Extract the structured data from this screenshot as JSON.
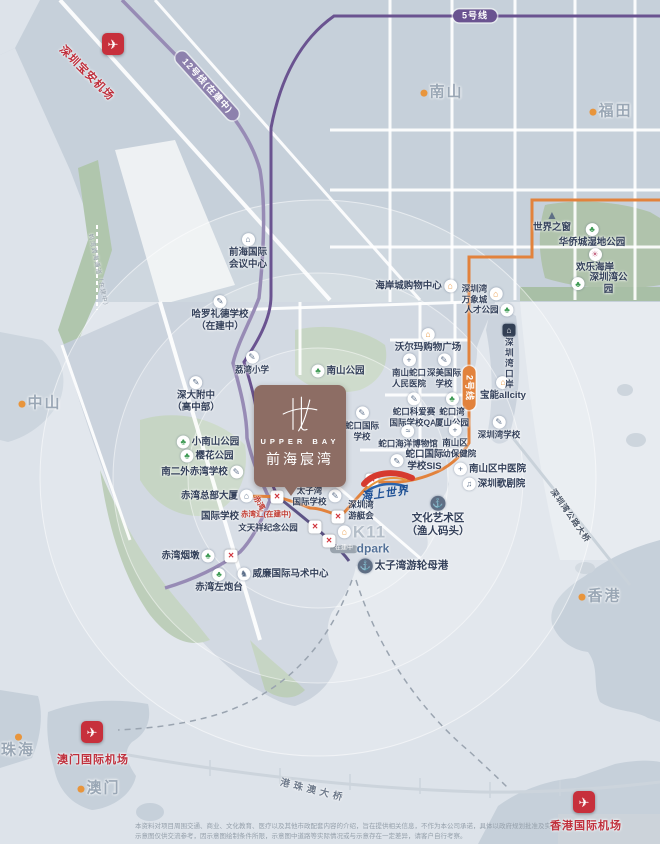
{
  "logo": {
    "name_en": "UPPER BAY",
    "name_cn": "前海宸湾"
  },
  "sea_world": {
    "label": "海上世界"
  },
  "station_glyph": "×",
  "icon_glyphs": {
    "park": "♣",
    "school": "✎",
    "shop": "⌂",
    "hospital": "+",
    "building": "⌂",
    "anchor": "⚓",
    "museum": "≈",
    "theater": "♫",
    "horse": "♞",
    "customs": "⌂",
    "pyramid": "▲",
    "attraction": "☀",
    "citydot": "",
    "airport": "✈"
  },
  "colors": {
    "brand_brown": "#8d6d64",
    "metro_purple": "#6a5390",
    "metro_purple_light": "#978bb5",
    "metro_orange": "#e2823c",
    "airport_red": "#c7303c",
    "label_dark": "#33405a",
    "sea": "#dde3ea",
    "land": "#c2ccd7",
    "park_green": "#b2c6ae"
  },
  "stations": [
    [
      277,
      497
    ],
    [
      372,
      480
    ],
    [
      338,
      517
    ],
    [
      315,
      527
    ],
    [
      329,
      541
    ],
    [
      231,
      556
    ]
  ],
  "pois": [
    {
      "id": "line5-pill",
      "label": "5号线",
      "x": 475,
      "y": 16,
      "cls": "pillp"
    },
    {
      "id": "line12-pill",
      "label": "12号线(在建中)",
      "x": 207,
      "y": 86,
      "cls": "pillp pill-l12",
      "rot": 48
    },
    {
      "id": "line2-pill",
      "label": "2号线",
      "x": 469,
      "y": 388,
      "cls": "pillp pill-l2",
      "rot": 90
    },
    {
      "id": "shenzhen-airport-icon",
      "x": 113,
      "y": 44,
      "icon": "airport"
    },
    {
      "id": "shenzhen-airport-label",
      "label": "深圳宝安机场",
      "x": 86,
      "y": 74,
      "cls": "airport-name",
      "rot": 45
    },
    {
      "id": "qianhai-conference-center",
      "label": "前海国际\n会议中心",
      "x": 248,
      "y": 252,
      "icon": "building",
      "ipos": "top"
    },
    {
      "id": "harrow-lide-school",
      "label": "哈罗礼德学校\n（在建中）",
      "x": 220,
      "y": 314,
      "icon": "school",
      "ipos": "top"
    },
    {
      "id": "liwan-primary-school",
      "label": "荔湾小学",
      "x": 252,
      "y": 363,
      "icon": "school",
      "ipos": "top",
      "cls": "small"
    },
    {
      "id": "nanshan-park",
      "label": "南山公园",
      "x": 338,
      "y": 371,
      "icon": "park",
      "ipos": "left"
    },
    {
      "id": "shenda-high-school",
      "label": "深大附中\n（高中部）",
      "x": 196,
      "y": 395,
      "icon": "school",
      "ipos": "top"
    },
    {
      "id": "xiaonanshan-park",
      "label": "小南山公园",
      "x": 208,
      "y": 442,
      "icon": "park",
      "ipos": "left"
    },
    {
      "id": "yinghua-park",
      "label": "樱花公园",
      "x": 207,
      "y": 456,
      "icon": "park",
      "ipos": "left"
    },
    {
      "id": "nanerwai-chiwan-school",
      "label": "南二外赤湾学校",
      "x": 202,
      "y": 472,
      "icon": "school",
      "ipos": "right"
    },
    {
      "id": "chiwan-headquarters-tower",
      "label": "赤湾总部大厦",
      "x": 217,
      "y": 496,
      "icon": "building",
      "ipos": "right"
    },
    {
      "id": "international-school",
      "label": "国际学校",
      "x": 220,
      "y": 517
    },
    {
      "id": "chiwanhui-label",
      "label": "赤湾汇(在建中)",
      "x": 266,
      "y": 514,
      "cls": "red tiny",
      "rot": 0
    },
    {
      "id": "chiwan-station-label",
      "label": "赤湾",
      "x": 259,
      "y": 503,
      "cls": "red tiny",
      "rot": 60
    },
    {
      "id": "wentianxiang-memorial-park",
      "label": "文天祥纪念公园",
      "x": 268,
      "y": 528,
      "cls": "small"
    },
    {
      "id": "chiwan-yandun",
      "label": "赤湾烟墩",
      "x": 188,
      "y": 556,
      "icon": "park",
      "ipos": "right"
    },
    {
      "id": "chiwan-left-fort",
      "label": "赤湾左炮台",
      "x": 219,
      "y": 581,
      "icon": "park",
      "ipos": "top"
    },
    {
      "id": "william-equestrian-center",
      "label": "威廉国际马术中心",
      "x": 283,
      "y": 574,
      "icon": "horse",
      "ipos": "left"
    },
    {
      "id": "taiziwan-international-school",
      "label": "太子湾\n国际学校",
      "x": 317,
      "y": 496,
      "icon": "school",
      "ipos": "right",
      "cls": "small"
    },
    {
      "id": "shenzhen-bay-yacht-club",
      "label": "深圳湾\n游艇会",
      "x": 361,
      "y": 510,
      "cls": "small"
    },
    {
      "id": "k11",
      "label": "K11",
      "x": 362,
      "y": 532,
      "icon": "shop",
      "ipos": "left",
      "cls": "k11"
    },
    {
      "id": "dpark-pill",
      "label": "在建中",
      "x": 344,
      "y": 549,
      "cls": "pill-grey"
    },
    {
      "id": "dpark",
      "label": "dpark",
      "x": 373,
      "y": 549,
      "cls": "dpark"
    },
    {
      "id": "taiziwan-cruise-home-port",
      "label": "太子湾游轮母港",
      "x": 403,
      "y": 566,
      "icon": "anchor",
      "ipos": "left",
      "cls": "bold11"
    },
    {
      "id": "culture-art-area",
      "label": "文化艺术区\n（渔人码头）",
      "x": 438,
      "y": 517,
      "icon": "anchor",
      "ipos": "top",
      "cls": "bold11"
    },
    {
      "id": "shekou-international-school",
      "label": "蛇口国际\n学校",
      "x": 362,
      "y": 424,
      "icon": "school",
      "ipos": "top",
      "cls": "small"
    },
    {
      "id": "qai-international-school",
      "label": "蛇口科爱赛\n国际学校QAI",
      "x": 414,
      "y": 410,
      "icon": "school",
      "ipos": "top",
      "cls": "small"
    },
    {
      "id": "wanxiashan-park",
      "label": "蛇口湾\n厦山公园",
      "x": 452,
      "y": 410,
      "icon": "park",
      "ipos": "top",
      "cls": "small"
    },
    {
      "id": "shekou-marine-museum",
      "label": "蛇口海洋博物馆",
      "x": 408,
      "y": 437,
      "icon": "museum",
      "ipos": "top",
      "cls": "small"
    },
    {
      "id": "fuyou-hospital",
      "label": "南山区\n妇幼保健院",
      "x": 455,
      "y": 441,
      "icon": "hospital",
      "ipos": "top",
      "cls": "small"
    },
    {
      "id": "sis-school",
      "label": "蛇口国际\n学校SIS",
      "x": 417,
      "y": 461,
      "icon": "school",
      "ipos": "left"
    },
    {
      "id": "nanshan-tcm-hospital",
      "label": "南山区中医院",
      "x": 490,
      "y": 469,
      "icon": "hospital",
      "ipos": "left"
    },
    {
      "id": "shenzhen-opera-house",
      "label": "深圳歌剧院",
      "x": 494,
      "y": 484,
      "icon": "theater",
      "ipos": "left"
    },
    {
      "id": "shenzhen-bay-school",
      "label": "深圳湾学校",
      "x": 499,
      "y": 428,
      "icon": "school",
      "ipos": "top",
      "cls": "small"
    },
    {
      "id": "baoneng-allcity",
      "label": "宝能allcity",
      "x": 503,
      "y": 389,
      "icon": "shop",
      "ipos": "top"
    },
    {
      "id": "shenzhen-bay-checkpoint",
      "label": "深圳湾口岸",
      "x": 509,
      "y": 357,
      "icon": "customs",
      "ipos": "top",
      "cls": "vert small"
    },
    {
      "id": "walmart-plaza",
      "label": "沃尔玛购物广场",
      "x": 428,
      "y": 341,
      "icon": "shop",
      "ipos": "top"
    },
    {
      "id": "shekou-people-hospital",
      "label": "南山蛇口\n人民医院",
      "x": 409,
      "y": 371,
      "icon": "hospital",
      "ipos": "top",
      "cls": "small"
    },
    {
      "id": "shenmei-international-school",
      "label": "深美国际\n学校",
      "x": 444,
      "y": 371,
      "icon": "school",
      "ipos": "top",
      "cls": "small"
    },
    {
      "id": "rencai-park",
      "label": "人才公园",
      "x": 489,
      "y": 310,
      "icon": "park",
      "ipos": "right",
      "cls": "small"
    },
    {
      "id": "shenzhen-bay-mixc",
      "label": "深圳湾\n万象城",
      "x": 482,
      "y": 294,
      "icon": "shop",
      "ipos": "right",
      "cls": "small"
    },
    {
      "id": "coastal-city-mall",
      "label": "海岸城购物中心",
      "x": 416,
      "y": 286,
      "icon": "shop",
      "ipos": "right"
    },
    {
      "id": "window-of-the-world",
      "label": "世界之窗",
      "x": 552,
      "y": 221,
      "icon": "pyramid",
      "ipos": "top"
    },
    {
      "id": "oct-wetland-park",
      "label": "华侨城湿地公园",
      "x": 592,
      "y": 236,
      "icon": "park",
      "ipos": "top"
    },
    {
      "id": "happy-coast",
      "label": "欢乐海岸",
      "x": 595,
      "y": 261,
      "icon": "attraction",
      "ipos": "top"
    },
    {
      "id": "shenzhen-bay-park",
      "label": "深圳湾公园",
      "x": 601,
      "y": 284,
      "icon": "park",
      "ipos": "left"
    },
    {
      "id": "city-nanshan",
      "label": "南山",
      "x": 442,
      "y": 93,
      "icon": "citydot",
      "ipos": "left",
      "cls": "city"
    },
    {
      "id": "city-futian",
      "label": "福田",
      "x": 611,
      "y": 112,
      "icon": "citydot",
      "ipos": "left",
      "cls": "city"
    },
    {
      "id": "city-zhongshan",
      "label": "中山",
      "x": 40,
      "y": 404,
      "icon": "citydot",
      "ipos": "left",
      "cls": "city"
    },
    {
      "id": "city-zhuhai",
      "label": "珠海",
      "x": 18,
      "y": 747,
      "icon": "citydot",
      "ipos": "top",
      "cls": "city"
    },
    {
      "id": "city-macau",
      "label": "澳门",
      "x": 99,
      "y": 789,
      "icon": "citydot",
      "ipos": "left",
      "cls": "city"
    },
    {
      "id": "city-hongkong",
      "label": "香港",
      "x": 600,
      "y": 597,
      "icon": "citydot",
      "ipos": "left",
      "cls": "city"
    },
    {
      "id": "macau-airport-icon",
      "x": 92,
      "y": 732,
      "icon": "airport"
    },
    {
      "id": "macau-airport-label",
      "label": "澳门国际机场",
      "x": 93,
      "y": 761,
      "cls": "airport-name"
    },
    {
      "id": "hongkong-airport-icon",
      "x": 584,
      "y": 802,
      "icon": "airport"
    },
    {
      "id": "hongkong-airport-label",
      "label": "香港国际机场",
      "x": 586,
      "y": 827,
      "cls": "airport-name"
    },
    {
      "id": "hzm-bridge-label",
      "label": "港珠澳大桥",
      "x": 313,
      "y": 791,
      "cls": "bridge",
      "rot": 14
    },
    {
      "id": "shenzhen-bay-bridge-label",
      "label": "深圳湾公路大桥",
      "x": 570,
      "y": 516,
      "cls": "bridge-sm",
      "rot": 55
    },
    {
      "id": "mawan-channel-label",
      "label": "妈湾跨海通道（在建中）",
      "x": 97,
      "y": 272,
      "cls": "channel",
      "rot": 78
    }
  ],
  "disclaimer": {
    "line1": "本资料对项目周围交通、商业、文化教育、医疗以及其他市政配套内容的介绍，旨在提供相关信息，不作为本公司承诺，具体以政府规划批准及实际交付为准，",
    "line2": "示意图仅供交流参考，因示意图绘制条件所限，示意图中道路等实际情况或与示意存在一定差异，请客户自行考察。"
  }
}
